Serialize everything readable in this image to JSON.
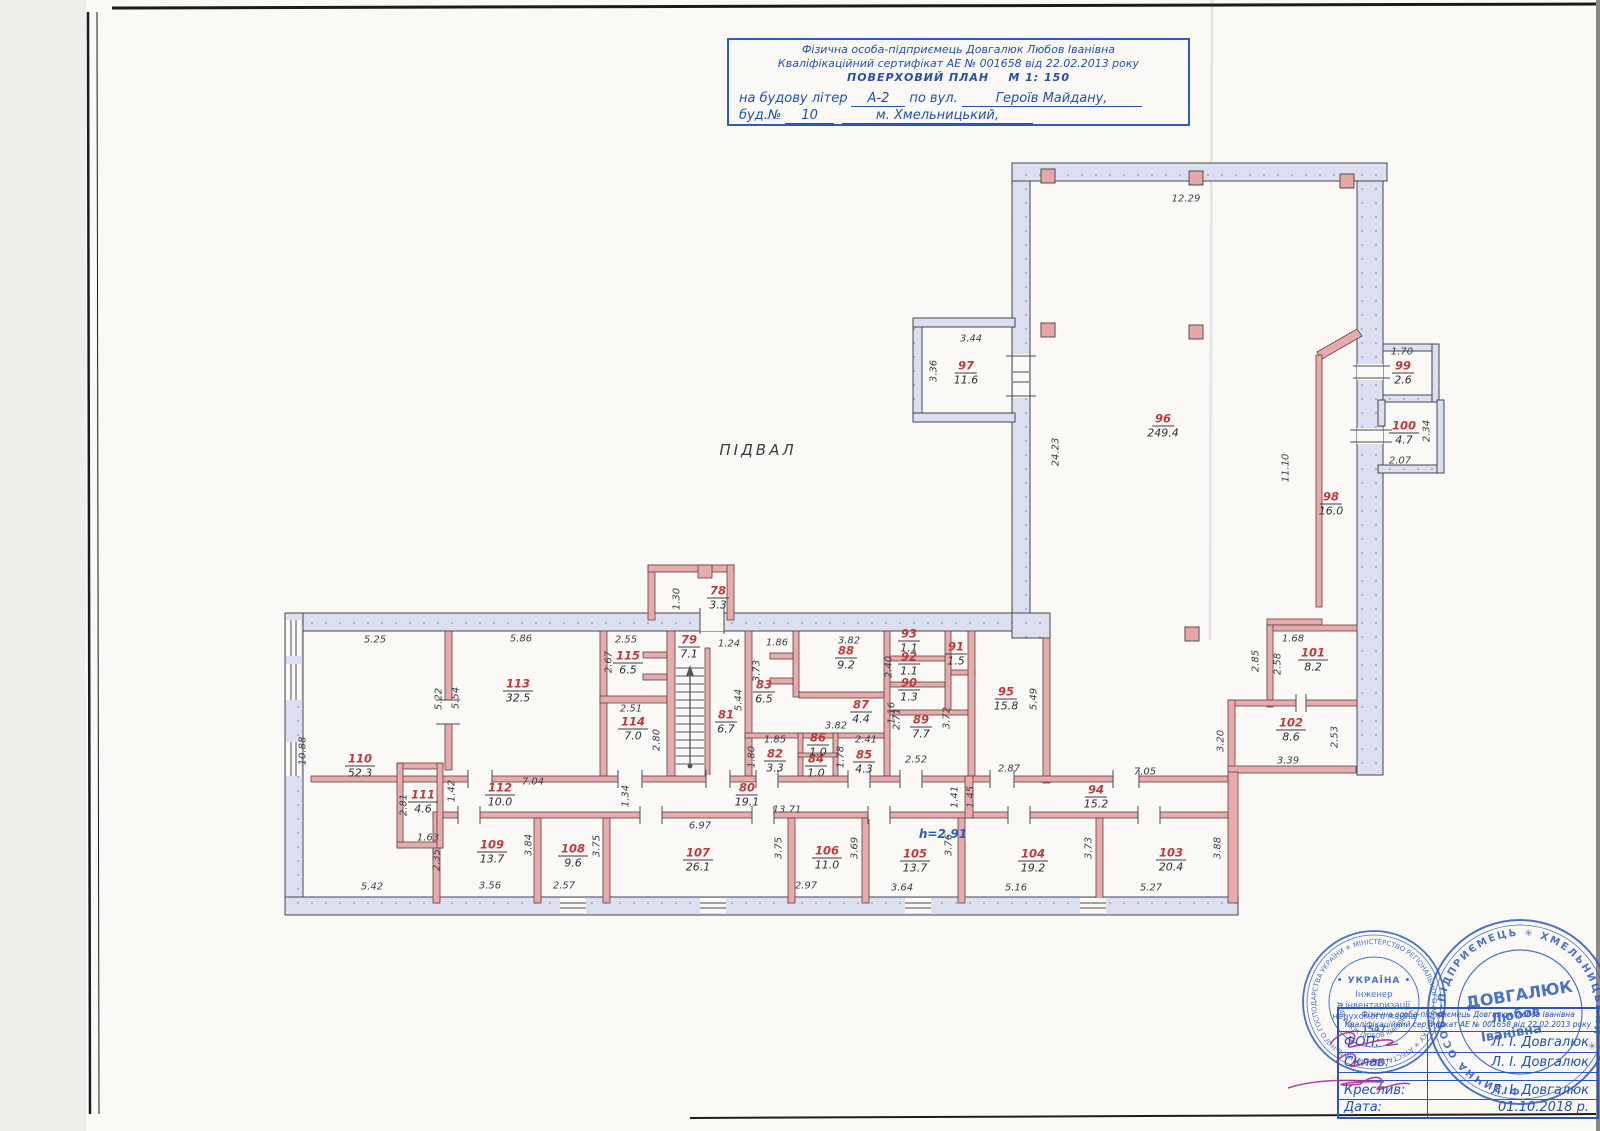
{
  "page": {
    "label_podval": "ПІДВАЛ"
  },
  "title_block": {
    "line1": "Фізична особа-підприємець Довгалюк Любов Іванівна",
    "line2": "Кваліфікаційний сертифікат АЕ № 001658 від 22.02.2013 року",
    "plan_title": "ПОВЕРХОВИЙ ПЛАН",
    "scale": "М 1: 150",
    "line4_pre": "на будову літер",
    "line4_val": "А-2",
    "line4_mid": "по вул.",
    "line4_val2": "Героїв Майдану,",
    "line5_pre": "буд.№",
    "line5_val": "10",
    "line5_val2": "м. Хмельницький,"
  },
  "plan": {
    "height_note": "h=2.91",
    "rooms": [
      {
        "n": "96",
        "a": "249.4",
        "x": 1163,
        "y": 424
      },
      {
        "n": "97",
        "a": "11.6",
        "x": 966,
        "y": 371
      },
      {
        "n": "98",
        "a": "16.0",
        "x": 1331,
        "y": 502
      },
      {
        "n": "99",
        "a": "2.6",
        "x": 1403,
        "y": 371
      },
      {
        "n": "100",
        "a": "4.7",
        "x": 1404,
        "y": 431
      },
      {
        "n": "101",
        "a": "8.2",
        "x": 1313,
        "y": 658
      },
      {
        "n": "102",
        "a": "8.6",
        "x": 1291,
        "y": 728
      },
      {
        "n": "78",
        "a": "3.3",
        "x": 718,
        "y": 596
      },
      {
        "n": "79",
        "a": "7.1",
        "x": 689,
        "y": 645
      },
      {
        "n": "81",
        "a": "6.7",
        "x": 726,
        "y": 720
      },
      {
        "n": "82",
        "a": "3.3",
        "x": 775,
        "y": 759
      },
      {
        "n": "83",
        "a": "6.5",
        "x": 764,
        "y": 690
      },
      {
        "n": "84",
        "a": "1.0",
        "x": 816,
        "y": 764
      },
      {
        "n": "85",
        "a": "4.3",
        "x": 864,
        "y": 760
      },
      {
        "n": "86",
        "a": "1.0",
        "x": 818,
        "y": 743
      },
      {
        "n": "87",
        "a": "4.4",
        "x": 861,
        "y": 710
      },
      {
        "n": "88",
        "a": "9.2",
        "x": 846,
        "y": 656
      },
      {
        "n": "89",
        "a": "7.7",
        "x": 921,
        "y": 725
      },
      {
        "n": "90",
        "a": "1.3",
        "x": 909,
        "y": 688
      },
      {
        "n": "91",
        "a": "1.5",
        "x": 956,
        "y": 652
      },
      {
        "n": "92",
        "a": "1.1",
        "x": 909,
        "y": 662
      },
      {
        "n": "93",
        "a": "1.1",
        "x": 909,
        "y": 639
      },
      {
        "n": "94",
        "a": "15.2",
        "x": 1096,
        "y": 795
      },
      {
        "n": "95",
        "a": "15.8",
        "x": 1006,
        "y": 697
      },
      {
        "n": "80",
        "a": "19.1",
        "x": 747,
        "y": 793
      },
      {
        "n": "103",
        "a": "20.4",
        "x": 1171,
        "y": 858
      },
      {
        "n": "104",
        "a": "19.2",
        "x": 1033,
        "y": 859
      },
      {
        "n": "105",
        "a": "13.7",
        "x": 915,
        "y": 859
      },
      {
        "n": "106",
        "a": "11.0",
        "x": 827,
        "y": 856
      },
      {
        "n": "107",
        "a": "26.1",
        "x": 698,
        "y": 858
      },
      {
        "n": "108",
        "a": "9.6",
        "x": 573,
        "y": 854
      },
      {
        "n": "109",
        "a": "13.7",
        "x": 492,
        "y": 850
      },
      {
        "n": "110",
        "a": "52.3",
        "x": 360,
        "y": 764
      },
      {
        "n": "111",
        "a": "4.6",
        "x": 423,
        "y": 800
      },
      {
        "n": "112",
        "a": "10.0",
        "x": 500,
        "y": 793
      },
      {
        "n": "113",
        "a": "32.5",
        "x": 518,
        "y": 689
      },
      {
        "n": "114",
        "a": "7.0",
        "x": 633,
        "y": 727
      },
      {
        "n": "115",
        "a": "6.5",
        "x": 628,
        "y": 661
      }
    ],
    "dims": [
      {
        "t": "12.29",
        "x": 1186,
        "y": 199
      },
      {
        "t": "3.44",
        "x": 971,
        "y": 339
      },
      {
        "t": "3.36",
        "x": 934,
        "y": 371,
        "r": 1
      },
      {
        "t": "24.23",
        "x": 1056,
        "y": 452,
        "r": 1
      },
      {
        "t": "11.10",
        "x": 1286,
        "y": 468,
        "r": 1
      },
      {
        "t": "1.70",
        "x": 1402,
        "y": 352
      },
      {
        "t": "2.34",
        "x": 1427,
        "y": 431,
        "r": 1
      },
      {
        "t": "2.07",
        "x": 1400,
        "y": 461
      },
      {
        "t": "1.68",
        "x": 1293,
        "y": 639
      },
      {
        "t": "2.85",
        "x": 1256,
        "y": 661,
        "r": 1
      },
      {
        "t": "2.58",
        "x": 1278,
        "y": 664,
        "r": 1
      },
      {
        "t": "2.53",
        "x": 1335,
        "y": 737,
        "r": 1
      },
      {
        "t": "3.39",
        "x": 1288,
        "y": 761
      },
      {
        "t": "3.20",
        "x": 1221,
        "y": 741,
        "r": 1
      },
      {
        "t": "7.05",
        "x": 1145,
        "y": 772
      },
      {
        "t": "2.87",
        "x": 1009,
        "y": 769
      },
      {
        "t": "5.49",
        "x": 1034,
        "y": 699,
        "r": 1
      },
      {
        "t": "5.25",
        "x": 375,
        "y": 640
      },
      {
        "t": "5.86",
        "x": 521,
        "y": 639
      },
      {
        "t": "2.55",
        "x": 626,
        "y": 640
      },
      {
        "t": "1.24",
        "x": 729,
        "y": 644
      },
      {
        "t": "1.86",
        "x": 777,
        "y": 643
      },
      {
        "t": "3.82",
        "x": 849,
        "y": 641
      },
      {
        "t": "2.67",
        "x": 609,
        "y": 662,
        "r": 1
      },
      {
        "t": "5.22",
        "x": 439,
        "y": 699,
        "r": 1
      },
      {
        "t": "5.54",
        "x": 456,
        "y": 698,
        "r": 1
      },
      {
        "t": "2.51",
        "x": 631,
        "y": 709
      },
      {
        "t": "2.80",
        "x": 657,
        "y": 740,
        "r": 1
      },
      {
        "t": "1.30",
        "x": 677,
        "y": 599,
        "r": 1
      },
      {
        "t": "3.73",
        "x": 757,
        "y": 671,
        "r": 1
      },
      {
        "t": "5.44",
        "x": 739,
        "y": 700,
        "r": 1
      },
      {
        "t": "2.40",
        "x": 889,
        "y": 667,
        "r": 1
      },
      {
        "t": "1.16",
        "x": 892,
        "y": 713,
        "r": 1
      },
      {
        "t": "3.82",
        "x": 836,
        "y": 726
      },
      {
        "t": "2.71",
        "x": 897,
        "y": 719,
        "r": 1
      },
      {
        "t": "3.72",
        "x": 947,
        "y": 718,
        "r": 1
      },
      {
        "t": "2.52",
        "x": 916,
        "y": 760
      },
      {
        "t": "1.85",
        "x": 775,
        "y": 740
      },
      {
        "t": "1.80",
        "x": 752,
        "y": 757,
        "r": 1
      },
      {
        "t": "2.41",
        "x": 866,
        "y": 740
      },
      {
        "t": "1.78",
        "x": 841,
        "y": 757,
        "r": 1
      },
      {
        "t": "10.88",
        "x": 303,
        "y": 751,
        "r": 1
      },
      {
        "t": "2.81",
        "x": 404,
        "y": 805,
        "r": 1
      },
      {
        "t": "1.63",
        "x": 428,
        "y": 838
      },
      {
        "t": "1.42",
        "x": 452,
        "y": 791,
        "r": 1
      },
      {
        "t": "7.04",
        "x": 533,
        "y": 782
      },
      {
        "t": "1.34",
        "x": 626,
        "y": 796,
        "r": 1
      },
      {
        "t": "6.97",
        "x": 700,
        "y": 826
      },
      {
        "t": "13.71",
        "x": 787,
        "y": 810
      },
      {
        "t": "1.41",
        "x": 955,
        "y": 797,
        "r": 1
      },
      {
        "t": "1.45",
        "x": 971,
        "y": 797,
        "r": 1
      },
      {
        "t": "2.35",
        "x": 437,
        "y": 860,
        "r": 1
      },
      {
        "t": "3.84",
        "x": 529,
        "y": 845,
        "r": 1
      },
      {
        "t": "3.75",
        "x": 597,
        "y": 846,
        "r": 1
      },
      {
        "t": "3.75",
        "x": 779,
        "y": 848,
        "r": 1
      },
      {
        "t": "3.69",
        "x": 855,
        "y": 848,
        "r": 1
      },
      {
        "t": "3.76",
        "x": 949,
        "y": 845,
        "r": 1
      },
      {
        "t": "3.73",
        "x": 1089,
        "y": 848,
        "r": 1
      },
      {
        "t": "3.88",
        "x": 1218,
        "y": 848,
        "r": 1
      },
      {
        "t": "5.42",
        "x": 372,
        "y": 887
      },
      {
        "t": "3.56",
        "x": 490,
        "y": 886
      },
      {
        "t": "2.57",
        "x": 564,
        "y": 886
      },
      {
        "t": "2.97",
        "x": 806,
        "y": 886
      },
      {
        "t": "3.64",
        "x": 902,
        "y": 888
      },
      {
        "t": "5.16",
        "x": 1016,
        "y": 888
      },
      {
        "t": "5.27",
        "x": 1151,
        "y": 888
      }
    ],
    "columns": [
      {
        "x": 1048,
        "y": 176
      },
      {
        "x": 1196,
        "y": 178
      },
      {
        "x": 1347,
        "y": 181
      },
      {
        "x": 1048,
        "y": 330
      },
      {
        "x": 1196,
        "y": 332
      },
      {
        "x": 1192,
        "y": 634
      }
    ]
  },
  "stamps": {
    "left": {
      "ring_outer": "КОМУНАЛЬНОГО ГОСПОДАРСТВА УКРАЇНИ ✳ МІНІСТЕРСТВО РЕГІОНАЛЬНОГО РОЗВИТКУ ✳ АТЕСТАЦІЙНА АРХІТЕКТУРНО-БУДІВЕЛЬНА КОМІСІЯ ✳",
      "ring_inner": "ДОВГАЛЮК ЛЮБОВ ІВАНІВНА ✳ КВАЛІФІКАЦІЙНИЙ СЕРТИФІКАТ",
      "country": "• УКРАЇНА •",
      "title1": "Інженер",
      "title2": "з інвентаризації",
      "title3": "нерухомого майна",
      "number": "1547"
    },
    "right": {
      "ring": "ФІЗИЧНА ОСОБА-ПІДПРИЄМЕЦЬ ✳ ХМЕЛЬНИЦЬКИЙ ✳",
      "name1": "ДОВГАЛЮК",
      "name2": "Любов",
      "name3": "Іванівна"
    }
  },
  "sign_table": {
    "header1": "Фізична особа-підприємець Довгалюк Любов Іванівна",
    "header2": "Кваліфікаційний сертифікат АЕ № 001658 від 22.02.2013 року",
    "rows": [
      {
        "label": "ФОП:",
        "value": "Л. І. Довгалюк"
      },
      {
        "label": "Склав:",
        "value": "Л. І. Довгалюк"
      },
      {
        "label": "Креслив:",
        "value": "Л. І. Довгалюк"
      },
      {
        "label": "Дата:",
        "value": "01.10.2018 р."
      }
    ]
  }
}
